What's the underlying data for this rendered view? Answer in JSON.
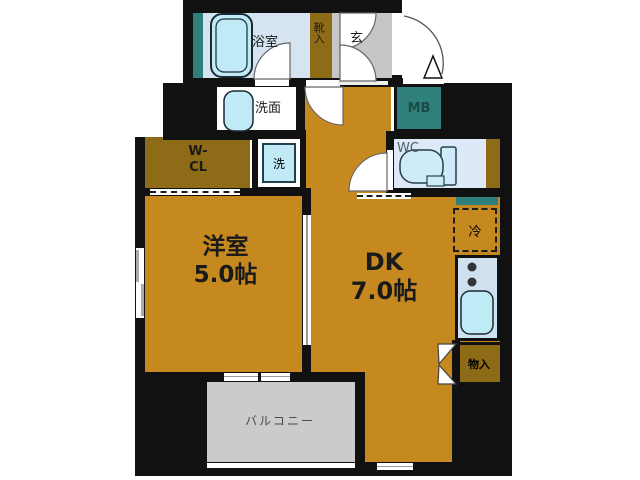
{
  "colors": {
    "wall": "#111111",
    "room_orange": "#c6891f",
    "closet_brown": "#8e6b16",
    "teal": "#2f7f7a",
    "entry_gray": "#c6c6c6",
    "balcony_gray": "#cbcbcb",
    "room_blue": "#d6e4f2",
    "wc_blue": "#dde9f7",
    "kitchen_blue": "#cfe0ee",
    "fixture_cyan": "#bfeaf6",
    "label_dark": "#1a1a1a",
    "label_teal": "#1d4a47"
  },
  "rooms": {
    "bathroom": {
      "label": "浴室"
    },
    "shoe_storage": {
      "label": "靴入"
    },
    "entrance": {
      "label": "玄"
    },
    "washroom": {
      "label": "洗面"
    },
    "meter_box": {
      "label": "MB"
    },
    "toilet": {
      "label": "WC"
    },
    "laundry": {
      "label": "洗"
    },
    "walk_in_closet": {
      "label_line1": "W-",
      "label_line2": "CL"
    },
    "western_room": {
      "label": "洋室",
      "size": "5.0帖"
    },
    "dining_kitchen": {
      "label": "DK",
      "size": "7.0帖"
    },
    "refrigerator": {
      "label": "冷"
    },
    "storage": {
      "label": "物入"
    },
    "balcony": {
      "label": "バルコニー"
    }
  }
}
